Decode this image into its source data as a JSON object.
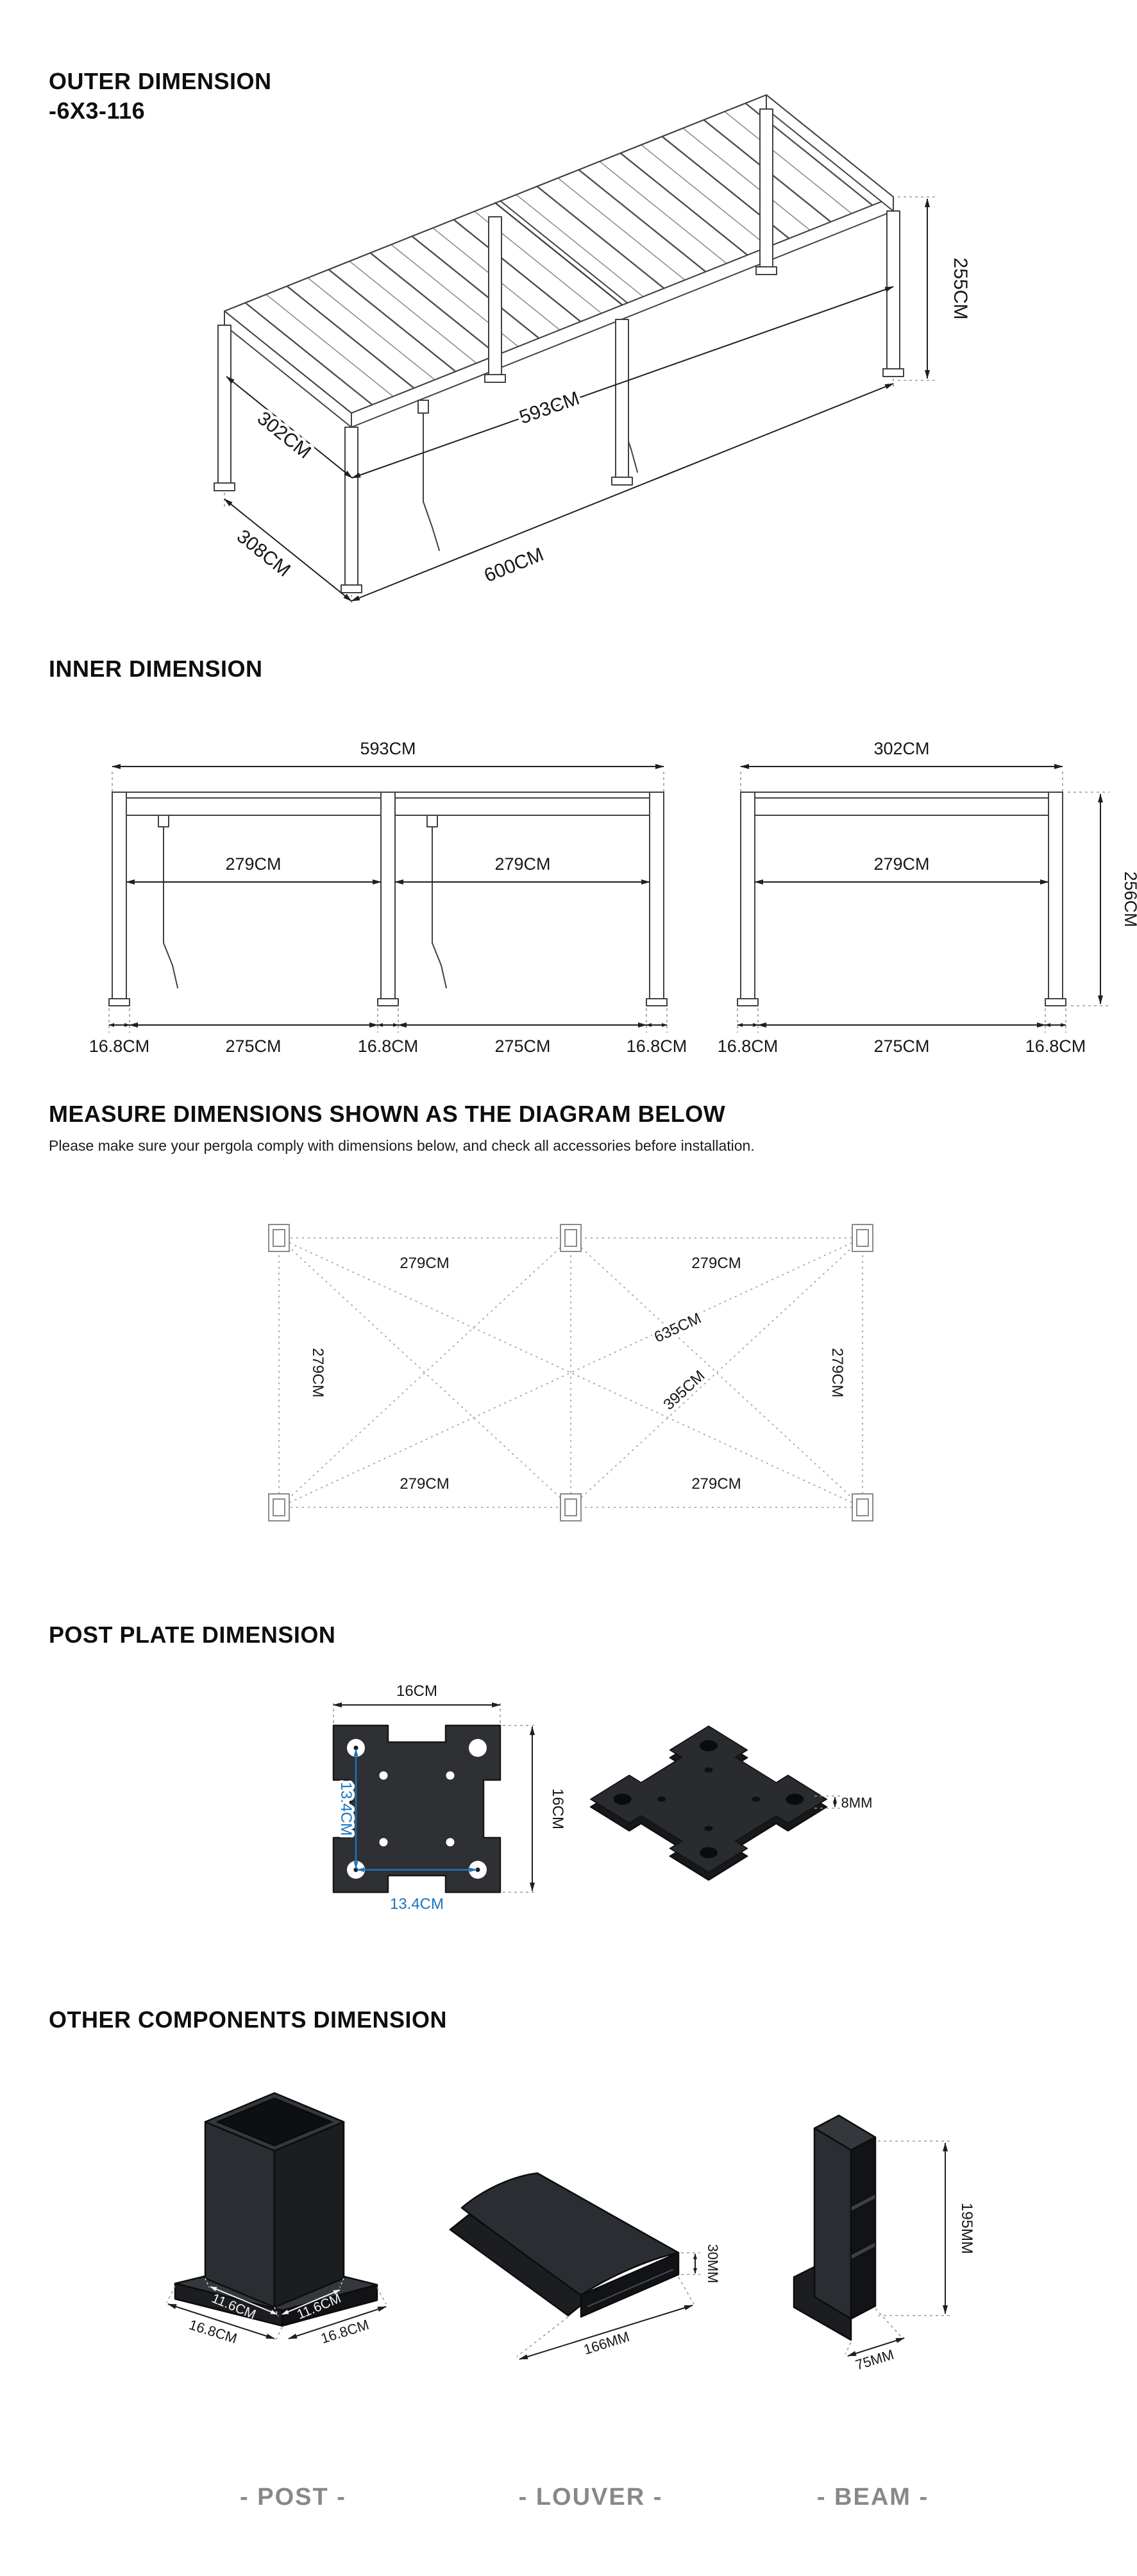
{
  "outer": {
    "title_line1": "OUTER DIMENSION",
    "title_line2": "-6X3-116",
    "height": "255CM",
    "inner_depth": "302CM",
    "inner_width": "593CM",
    "outer_depth": "308CM",
    "outer_width": "600CM"
  },
  "inner": {
    "title": "INNER DIMENSION",
    "front": {
      "overall": "593CM",
      "bay_left": "279CM",
      "bay_right": "279CM",
      "segs": [
        "16.8CM",
        "275CM",
        "16.8CM",
        "275CM",
        "16.8CM"
      ]
    },
    "side": {
      "overall": "302CM",
      "bay": "279CM",
      "height": "256CM",
      "segs": [
        "16.8CM",
        "275CM",
        "16.8CM"
      ]
    }
  },
  "measure": {
    "title": "MEASURE DIMENSIONS SHOWN AS THE DIAGRAM BELOW",
    "subtitle": "Please make sure your pergola comply with dimensions below, and check all accessories before installation.",
    "span_top_left": "279CM",
    "span_top_right": "279CM",
    "span_bottom_left": "279CM",
    "span_bottom_right": "279CM",
    "span_left": "279CM",
    "span_right": "279CM",
    "diagonal_full": "635CM",
    "diagonal_half": "395CM"
  },
  "plate": {
    "title": "POST PLATE DIMENSION",
    "width": "16CM",
    "height": "16CM",
    "hole_spacing_vertical": "13.4CM",
    "hole_spacing_horizontal": "13.4CM",
    "thickness": "8MM",
    "accent_blue": "#1b75bc"
  },
  "components": {
    "title": "OTHER COMPONENTS DIMENSION",
    "post": {
      "caption": "- POST -",
      "top_width": "11.6CM",
      "top_depth": "11.6CM",
      "base_width": "16.8CM",
      "base_depth": "16.8CM"
    },
    "louver": {
      "caption": "- LOUVER -",
      "thickness": "30MM",
      "width": "166MM"
    },
    "beam": {
      "caption": "- BEAM -",
      "height": "195MM",
      "width": "75MM"
    }
  }
}
